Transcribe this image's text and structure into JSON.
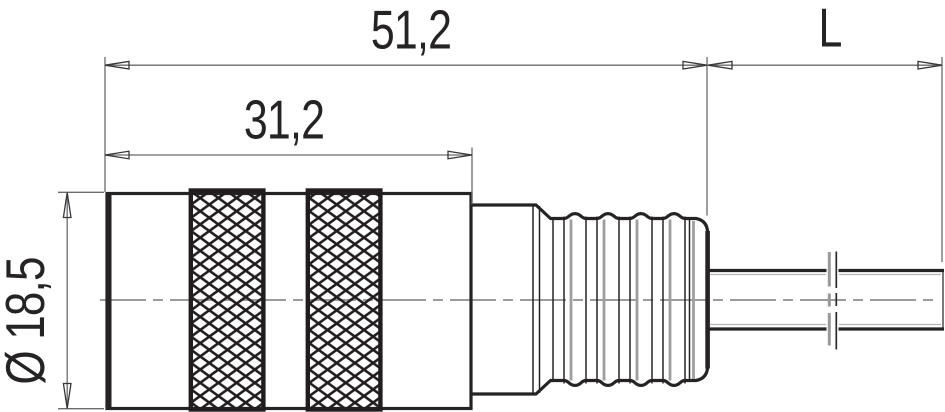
{
  "drawing": {
    "kind": "technical-dimension-drawing",
    "view": "connector-side-view",
    "labels": {
      "overall_length": "51,2",
      "front_length": "31,2",
      "cable_length": "L",
      "diameter": "Ø 18,5"
    },
    "colors": {
      "outline": "#262324",
      "dimension_line": "#696b6e",
      "centerline": "#8d8f91",
      "rib_shading": "#9e9e9e",
      "background": "#ffffff"
    }
  }
}
